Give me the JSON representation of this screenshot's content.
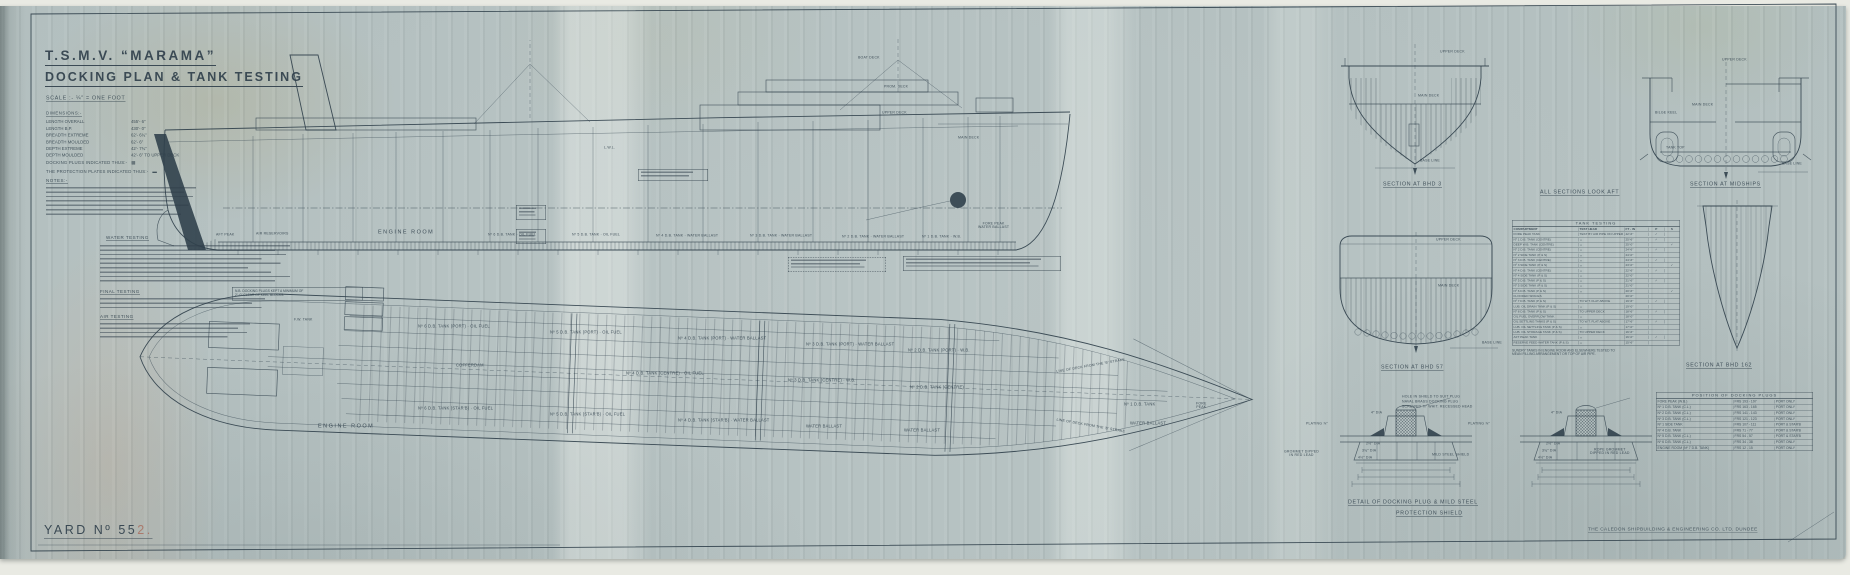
{
  "document": {
    "title_line1": "T.S.M.V. “MARAMA”",
    "title_line2": "DOCKING PLAN & TANK TESTING",
    "scale_note": "SCALE :-  ¼″ = ONE FOOT",
    "yard_prefix": "YARD  Nº",
    "yard_number_dark": "55",
    "y4ard_note": "",
    "yard_number_faded": "2.",
    "builder_stamp": "THE CALEDON SHIPBUILDING & ENGINEERING CO. LTD.  DUNDEE"
  },
  "particulars": {
    "heading": "DIMENSIONS:-",
    "rows": [
      {
        "label": "LENGTH OVERALL",
        "value": "455′- 6″"
      },
      {
        "label": "LENGTH B.P.",
        "value": "430′- 0″"
      },
      {
        "label": "BREADTH EXTREME",
        "value": "62′- 6¾″"
      },
      {
        "label": "BREADTH MOULDED",
        "value": "62′- 6″"
      },
      {
        "label": "DEPTH EXTREME",
        "value": "42′- 7¾″"
      },
      {
        "label": "DEPTH MOULDED",
        "value": "42′- 6″ TO UPPER DECK"
      }
    ]
  },
  "legend": {
    "plugs_label": "DOCKING PLUGS INDICATED THUS:-",
    "plugs_symbol": "▩",
    "shields_label": "THE PROTECTION PLATES INDICATED THUS:-",
    "shields_symbol": "▬",
    "notes_heading": "NOTES:-",
    "water_testing_heading": "WATER TESTING",
    "final_testing_heading": "FINAL TESTING",
    "air_testing_heading": "AIR TESTING"
  },
  "nb_note": {
    "line1": "N.B. DOCKING PLUGS KEPT A MINIMUM OF",
    "line2": "2′- 0″ CLEAR OF KEEL BLOCKS."
  },
  "tables": {
    "tank_testing": {
      "title": "TANK  TESTING",
      "headers": [
        "COMPARTMENT",
        "TEST HEAD",
        "FT - IN",
        "P",
        "S"
      ],
      "rows": [
        [
          "FORE PEAK TANK",
          "TEST BY AIR PIPE ON UPPER DECK",
          "42′-6″",
          "✓",
          ""
        ],
        [
          "Nº 1 D.B. TANK (CENTRE)",
          "〃",
          "25′-6″",
          "✓",
          ""
        ],
        [
          "DEEP W.B. TANK (CENTRE)",
          "〃",
          "25′-0″",
          "",
          "✓"
        ],
        [
          "Nº 2 D.B. TANK (CENTRE)",
          "〃",
          "24′-6″",
          "✓",
          ""
        ],
        [
          "Nº 2 SIDE TANK (P & S)",
          "〃",
          "24′-0″",
          "",
          ""
        ],
        [
          "Nº 3 D.B. TANK (CENTRE)",
          "〃",
          "24′-6″",
          "✓",
          ""
        ],
        [
          "Nº 3 SIDE TANK (P & S)",
          "〃",
          "23′-0″",
          "",
          "✓"
        ],
        [
          "Nº 4 D.B. TANK (CENTRE)",
          "〃",
          "22′-6″",
          "✓",
          ""
        ],
        [
          "Nº 4 SIDE TANK (P & S)",
          "〃",
          "22′-0″",
          "",
          ""
        ],
        [
          "Nº 5 D.B. TANK (P & S)",
          "〃",
          "21′-6″",
          "✓",
          ""
        ],
        [
          "Nº 5 SIDE TANK (P & S)",
          "〃",
          "21′-0″",
          "",
          ""
        ],
        [
          "Nº 6 D.B. TANK (P & S)",
          "〃",
          "20′-6″",
          "",
          "✓"
        ],
        [
          "FLOODED SPACES",
          "",
          "20′-0″",
          "",
          ""
        ],
        [
          "Nº 7 D.B. TANK (P & S)",
          "TO W.T. FLAT ABOVE",
          "19′-6″",
          "✓",
          ""
        ],
        [
          "LUB. OIL DRAIN TANK (P & S)",
          "〃",
          "19′-0″",
          "",
          ""
        ],
        [
          "Nº 8 D.B. TANK (P & S)",
          "TO UPPER DECK",
          "18′-6″",
          "✓",
          ""
        ],
        [
          "OIL FUEL OVERFLOW TANK",
          "〃",
          "18′-0″",
          "",
          ""
        ],
        [
          "OIL SETTLING TANKS (P & S)",
          "TO W.T. FLAT ABOVE",
          "17′-6″",
          "✓",
          ""
        ],
        [
          "LUB. OIL SETTLING TANK (P & S)",
          "〃",
          "17′-0″",
          "",
          ""
        ],
        [
          "LUB. OIL STORAGE TANK (P & S)",
          "TO UPPER DECK",
          "16′-6″",
          "",
          ""
        ],
        [
          "AFT PEAK TANK",
          "〃",
          "16′-0″",
          "✓",
          ""
        ],
        [
          "RESERVE FEED WATER TANK (P & S)",
          "〃",
          "15′-6″",
          "",
          ""
        ]
      ],
      "note1": "SUNDRY TANKS IN ENGINE ROOM AND ELSEWHERE TESTED TO",
      "note2": "MEAN FILLING ARRANGEMENT OR TOP OF AIR PIPE."
    },
    "docking_plugs": {
      "title": "POSITION  OF  DOCKING  PLUGS",
      "rows": [
        [
          "FORE PEAK (W.B.)",
          "FRS 193 - 197",
          "PORT ONLY"
        ],
        [
          "Nº 1 D.B. TANK (C.L.)",
          "FRS 163 - 165",
          "PORT ONLY"
        ],
        [
          "Nº 2 D.B. TANK (C.L.)",
          "FRS 141 - 143",
          "PORT ONLY"
        ],
        [
          "Nº 3 D.B. TANK (C.L.)",
          "FRS 121 - 123",
          "PORT ONLY"
        ],
        [
          "Nº 1 SIDE TANK",
          "FRS 107 - 111",
          "PORT & STAR'B"
        ],
        [
          "Nº 4 D.B. TANK",
          "FRS 71 - 77",
          "PORT & STAR'B"
        ],
        [
          "Nº 5 D.B. TANK (C.L.)",
          "FRS 54 - 57",
          "PORT & STAR'B"
        ],
        [
          "Nº 6 D.B. TANK (C.L.)",
          "FRS 34 - 38",
          "PORT ONLY"
        ],
        [
          "ENGINE ROOM (Nº 7 D.B. TANK)",
          "FRS 12 - 15",
          "PORT ONLY"
        ]
      ]
    }
  },
  "annotations": [
    {
      "x": 1383,
      "y": 181,
      "t": "SECTION AT BHD 3",
      "c": "a-cap",
      "n": "caption-section-bhd3"
    },
    {
      "x": 1540,
      "y": 189,
      "t": "ALL SECTIONS LOOK AFT",
      "c": "a-cap",
      "n": "caption-sections-look-aft"
    },
    {
      "x": 1690,
      "y": 181,
      "t": "SECTION AT MIDSHIPS",
      "c": "a-cap",
      "n": "caption-section-midships"
    },
    {
      "x": 1381,
      "y": 364,
      "t": "SECTION AT BHD 57",
      "c": "a-cap",
      "n": "caption-section-bhd57"
    },
    {
      "x": 1686,
      "y": 362,
      "t": "SECTION AT BHD 162",
      "c": "a-cap",
      "n": "caption-section-bhd162"
    },
    {
      "x": 1348,
      "y": 499,
      "t": "DETAIL OF DOCKING PLUG & MILD STEEL",
      "c": "a-cap",
      "n": "caption-plug-detail"
    },
    {
      "x": 1396,
      "y": 510,
      "t": "PROTECTION SHIELD",
      "c": "a-cap",
      "n": "caption-protection-shield"
    },
    {
      "x": 378,
      "y": 229,
      "t": "ENGINE ROOM",
      "c": "a-big",
      "n": "profile-engine-room-label"
    },
    {
      "x": 318,
      "y": 423,
      "t": "ENGINE ROOM",
      "c": "a-big",
      "n": "plan-engine-room-label"
    },
    {
      "x": 1440,
      "y": 50,
      "t": "UPPER DECK",
      "c": "a-t"
    },
    {
      "x": 1418,
      "y": 94,
      "t": "MAIN DECK",
      "c": "a-t"
    },
    {
      "x": 1420,
      "y": 159,
      "t": "BASE LINE",
      "c": "a-t"
    },
    {
      "x": 1722,
      "y": 58,
      "t": "UPPER DECK",
      "c": "a-t"
    },
    {
      "x": 1692,
      "y": 103,
      "t": "MAIN DECK",
      "c": "a-t"
    },
    {
      "x": 1666,
      "y": 146,
      "t": "TANK TOP",
      "c": "a-t"
    },
    {
      "x": 1655,
      "y": 111,
      "t": "BILGE KEEL",
      "c": "a-t"
    },
    {
      "x": 1782,
      "y": 162,
      "t": "BASE LINE",
      "c": "a-t"
    },
    {
      "x": 1436,
      "y": 238,
      "t": "UPPER DECK",
      "c": "a-t"
    },
    {
      "x": 1438,
      "y": 284,
      "t": "MAIN DECK",
      "c": "a-t"
    },
    {
      "x": 1482,
      "y": 341,
      "t": "BASE LINE",
      "c": "a-t"
    },
    {
      "x": 858,
      "y": 56,
      "t": "BOAT DECK",
      "c": "a-t"
    },
    {
      "x": 884,
      "y": 85,
      "t": "PROM. DECK",
      "c": "a-t"
    },
    {
      "x": 882,
      "y": 111,
      "t": "UPPER DECK",
      "c": "a-t"
    },
    {
      "x": 958,
      "y": 136,
      "t": "MAIN DECK",
      "c": "a-t"
    },
    {
      "x": 604,
      "y": 146,
      "t": "L.W.L.",
      "c": "a-t"
    },
    {
      "x": 216,
      "y": 233,
      "t": "AFT PEAK",
      "c": "a-t"
    },
    {
      "x": 256,
      "y": 232,
      "t": "AIR RESERVOIRS",
      "c": "a-t"
    },
    {
      "x": 488,
      "y": 233,
      "t": "Nº 6 D.B. TANK · OIL FUEL",
      "c": "a-t"
    },
    {
      "x": 572,
      "y": 233,
      "t": "Nº 5 D.B. TANK · OIL FUEL",
      "c": "a-t"
    },
    {
      "x": 656,
      "y": 234,
      "t": "Nº 4 D.B. TANK · WATER BALLAST",
      "c": "a-t"
    },
    {
      "x": 750,
      "y": 234,
      "t": "Nº 3 D.B. TANK · WATER BALLAST",
      "c": "a-t"
    },
    {
      "x": 842,
      "y": 235,
      "t": "Nº 2 D.B. TANK · WATER BALLAST",
      "c": "a-t"
    },
    {
      "x": 922,
      "y": 235,
      "t": "Nº 1 D.B. TANK · W.B.",
      "c": "a-t"
    },
    {
      "x": 978,
      "y": 222,
      "t": "FORE PEAK\nWATER BALLAST",
      "c": "a-t a-2l"
    },
    {
      "x": 418,
      "y": 324,
      "t": "Nº 6 D.B. TANK (PORT) · OIL FUEL",
      "c": "a-lbl"
    },
    {
      "x": 550,
      "y": 330,
      "t": "Nº 5 D.B. TANK (PORT) · OIL FUEL",
      "c": "a-lbl"
    },
    {
      "x": 678,
      "y": 336,
      "t": "Nº 4 D.B. TANK (PORT) · WATER BALLAST",
      "c": "a-lbl"
    },
    {
      "x": 806,
      "y": 342,
      "t": "Nº 3 D.B. TANK (PORT) · WATER BALLAST",
      "c": "a-lbl"
    },
    {
      "x": 908,
      "y": 348,
      "t": "Nº 2 D.B. TANK (PORT) · W.B.",
      "c": "a-lbl"
    },
    {
      "x": 456,
      "y": 363,
      "t": "COFFERDAM",
      "c": "a-lbl"
    },
    {
      "x": 626,
      "y": 371,
      "t": "Nº 4 D.B. TANK (CENTRE) · OIL FUEL",
      "c": "a-lbl"
    },
    {
      "x": 788,
      "y": 378,
      "t": "Nº 3 D.B. TANK (CENTRE) · W.B.",
      "c": "a-lbl"
    },
    {
      "x": 910,
      "y": 385,
      "t": "Nº 2 D.B. TANK (CENTRE)",
      "c": "a-lbl"
    },
    {
      "x": 1124,
      "y": 402,
      "t": "Nº 1 D.B. TANK",
      "c": "a-lbl"
    },
    {
      "x": 1130,
      "y": 421,
      "t": "WATER BALLAST",
      "c": "a-lbl"
    },
    {
      "x": 1196,
      "y": 402,
      "t": "FORE\nPEAK",
      "c": "a-t a-2l"
    },
    {
      "x": 418,
      "y": 406,
      "t": "Nº 6 D.B. TANK (STAR'B) · OIL FUEL",
      "c": "a-lbl"
    },
    {
      "x": 550,
      "y": 412,
      "t": "Nº 5 D.B. TANK (STAR'B) · OIL FUEL",
      "c": "a-lbl"
    },
    {
      "x": 678,
      "y": 418,
      "t": "Nº 4 D.B. TANK (STAR'B) · WATER BALLAST",
      "c": "a-lbl"
    },
    {
      "x": 806,
      "y": 424,
      "t": "WATER BALLAST",
      "c": "a-lbl"
    },
    {
      "x": 904,
      "y": 428,
      "t": "WATER BALLAST",
      "c": "a-lbl"
    },
    {
      "x": 1056,
      "y": 364,
      "t": "LINE OF DECK FROM THE 'B' STRAKE",
      "c": "a-t",
      "r": -10
    },
    {
      "x": 1056,
      "y": 424,
      "t": "LINE OF DECK FROM THE 'B' STRAKE",
      "c": "a-t",
      "r": 10
    },
    {
      "x": 294,
      "y": 318,
      "t": "F.W. TANK",
      "c": "a-t"
    },
    {
      "x": 1306,
      "y": 422,
      "t": "PLATING ⅞″",
      "c": "a-t"
    },
    {
      "x": 1468,
      "y": 422,
      "t": "PLATING ⅞″",
      "c": "a-t"
    },
    {
      "x": 1432,
      "y": 453,
      "t": "MILD STEEL SHIELD",
      "c": "a-t"
    },
    {
      "x": 1284,
      "y": 450,
      "t": "GROMMET DIPPED\nIN RED LEAD",
      "c": "a-t a-2l"
    },
    {
      "x": 1590,
      "y": 448,
      "t": "ROPE GROMMET\nDIPPED IN RED LEAD",
      "c": "a-t a-2l"
    },
    {
      "x": 1402,
      "y": 395,
      "t": "HOLE IN SHIELD TO SUIT PLUG",
      "c": "a-t"
    },
    {
      "x": 1402,
      "y": 400,
      "t": "NAVAL BRASS DOCKING PLUG",
      "c": "a-t"
    },
    {
      "x": 1402,
      "y": 405,
      "t": "SCREWED ⅞″ WHIT. RECESSED HEAD",
      "c": "a-t"
    },
    {
      "x": 1366,
      "y": 442,
      "t": "2½″ DIA",
      "c": "a-t"
    },
    {
      "x": 1362,
      "y": 449,
      "t": "3¾″ DIA",
      "c": "a-t"
    },
    {
      "x": 1358,
      "y": 456,
      "t": "4½″ DIA",
      "c": "a-t"
    },
    {
      "x": 1546,
      "y": 442,
      "t": "2½″ DIA",
      "c": "a-t"
    },
    {
      "x": 1542,
      "y": 449,
      "t": "3¾″ DIA",
      "c": "a-t"
    },
    {
      "x": 1538,
      "y": 456,
      "t": "4½″ DIA",
      "c": "a-t"
    },
    {
      "x": 1371,
      "y": 411,
      "t": "4″ DIA",
      "c": "a-t"
    },
    {
      "x": 1551,
      "y": 411,
      "t": "4″ DIA",
      "c": "a-t"
    }
  ]
}
